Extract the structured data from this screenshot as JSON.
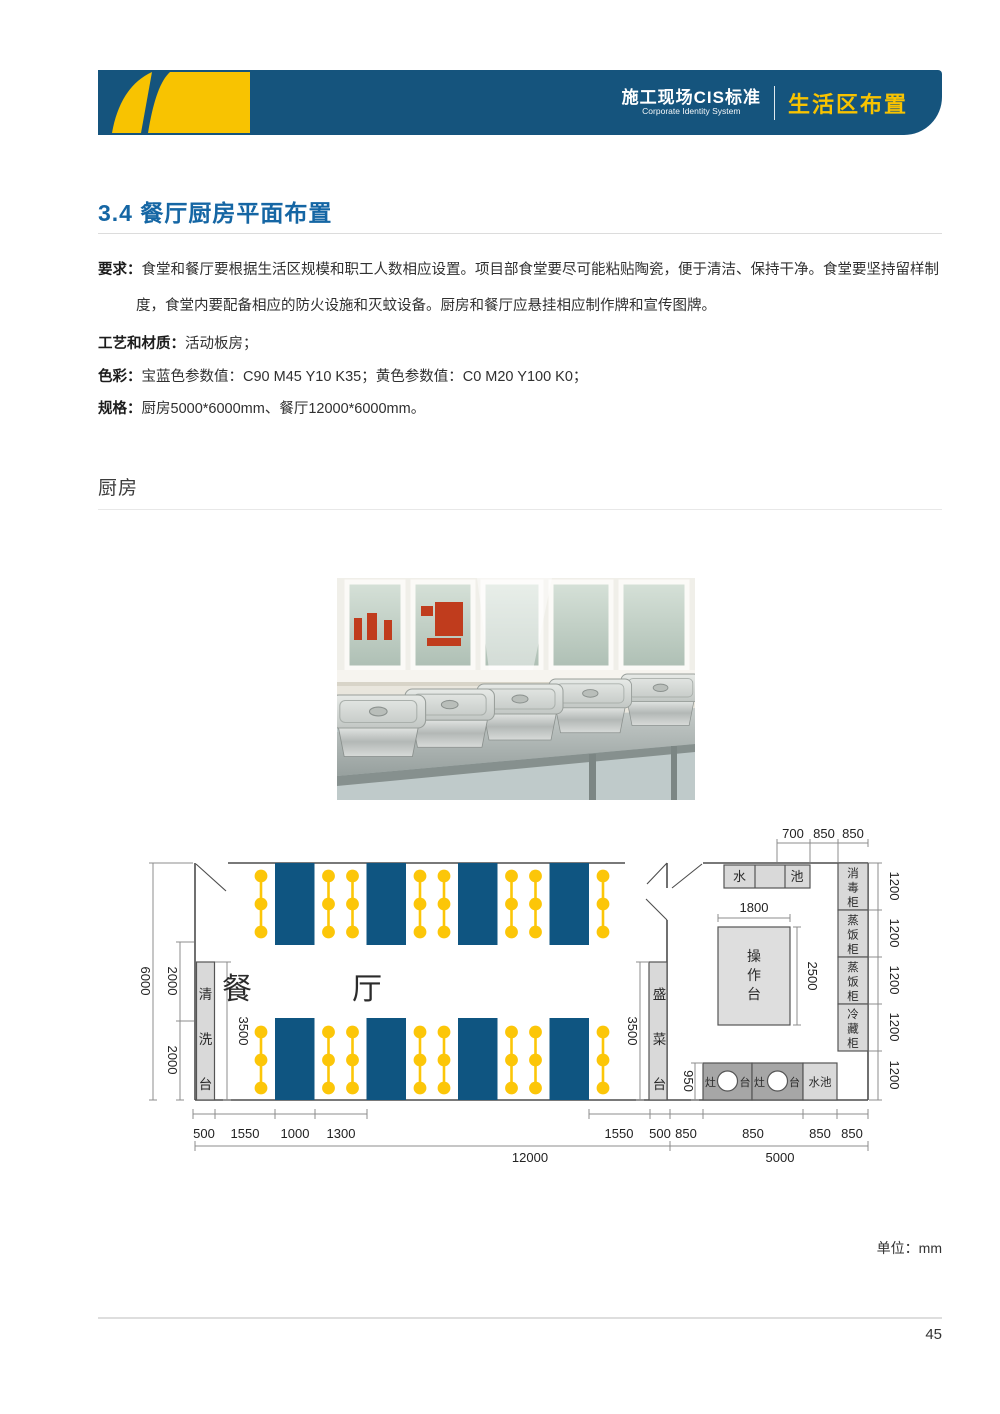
{
  "header": {
    "cis_title": "施工现场CIS标准",
    "cis_subtitle": "Corporate Identity System",
    "section_title": "生活区布置"
  },
  "article": {
    "heading": "3.4 餐厅厨房平面布置",
    "req_label": "要求：",
    "req_text": "食堂和餐厅要根据生活区规模和职工人数相应设置。项目部食堂要尽可能粘贴陶瓷，便于清洁、保持干净。食堂要坚持留样制度，食堂内要配备相应的防火设施和灭蚊设备。厨房和餐厅应悬挂相应制作牌和宣传图牌。",
    "craft_label": "工艺和材质：",
    "craft_text": "活动板房；",
    "color_label": "色彩：",
    "color_text": "宝蓝色参数值：C90 M45 Y10 K35；黄色参数值：C0 M20 Y100 K0；",
    "spec_label": "规格：",
    "spec_text": "厨房5000*6000mm、餐厅12000*6000mm。",
    "section_label": "厨房",
    "unit_note": "单位：mm",
    "page_number": "45"
  },
  "plan": {
    "dining_label": "餐厅",
    "fixtures": {
      "wash_table": "清洗台",
      "serve_table": "盛菜台",
      "sink_left": "水",
      "sink_right": "池",
      "cabinets": [
        "消毒柜",
        "蒸饭柜",
        "蒸饭柜",
        "冷藏柜"
      ],
      "work_table": "操作台",
      "stove_left": "灶",
      "stove_right": "台",
      "small_sink": "水池"
    },
    "dims": {
      "top": [
        "700",
        "850",
        "850"
      ],
      "left_total": "6000",
      "left_segments": [
        "2000",
        "2000"
      ],
      "wash_len": "3500",
      "serve_len": "3500",
      "work_w": "1800",
      "work_h": "2500",
      "stove_depth": "950",
      "right_segments": [
        "1200",
        "1200",
        "1200",
        "1200",
        "1200"
      ],
      "bottom_left": [
        "500",
        "1550",
        "1000",
        "1300"
      ],
      "bottom_right": [
        "1550",
        "500",
        "850",
        "850",
        "850",
        "850"
      ],
      "dining_total": "12000",
      "kitchen_total": "5000"
    }
  },
  "colors": {
    "brand_blue": "#15547d",
    "brand_yellow": "#f8c301",
    "heading_blue": "#1566a4",
    "table_blue": "#0f5581",
    "stool_yellow": "#fcc608",
    "fixture_gray": "#d9d9d9",
    "stove_gray": "#a6a6a6"
  }
}
